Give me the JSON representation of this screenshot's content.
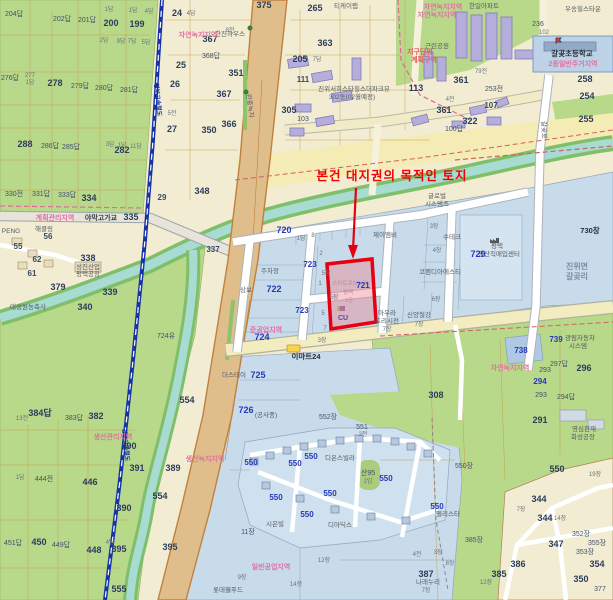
{
  "annotation": {
    "text": "본건 대지권의 목적인 토지",
    "color": "#f50000",
    "outline_color": "#e60012"
  },
  "subject_parcel": {
    "number": "721",
    "building": "스마트큐브누리",
    "city": "평택",
    "unit": "2공",
    "store": "CU"
  },
  "colors": {
    "field_green": "#b8d88a",
    "urban_blue": "#c7dbeb",
    "water": "#a8dbd2",
    "road_tan": "#dfbe8c",
    "railway_blue": "#1733a8",
    "zone_pink": "#e46fa5",
    "parcel_number_blue": "#2639b8",
    "annotation_red": "#f50000"
  },
  "labels": {
    "p204": "204답",
    "p202": "202답",
    "p201": "201답",
    "p200": "200",
    "p199": "199",
    "p1a": "1답",
    "p1b": "1답",
    "p4a": "4답",
    "p2a": "2답",
    "p9a": "9답",
    "p7a": "7답",
    "p5a": "5답",
    "p276": "276답",
    "p277": "277",
    "p277b": "1답",
    "p278": "278",
    "p279": "279답",
    "p280": "280답",
    "p281": "281답",
    "p288": "288",
    "p286": "286답",
    "p285": "285답",
    "p3a": "3답",
    "p1c": "1답",
    "p11a": "11답",
    "p24": "24",
    "p4b": "4답",
    "p25": "25",
    "p26": "26",
    "p27": "27",
    "p5b": "5전",
    "p350": "350",
    "p282": "282",
    "p29": "29",
    "p348": "348",
    "p330": "330전",
    "p331": "331답",
    "p333": "333답",
    "p334": "334",
    "p335": "335",
    "bridge": "야막고가교",
    "z_gyehoek": "계획관리지역",
    "n_haek": "해클링",
    "p56": "56",
    "p55": "55",
    "p62": "62",
    "p61": "61",
    "p338": "338",
    "n_sungjin1": "성진산업",
    "n_sungjin2": "평택공장",
    "p379": "379",
    "p339": "339",
    "p340": "340",
    "n_daesung": "대성원농축사",
    "n_peng": "PENG",
    "rail1": "경부고속철도",
    "rail2": "경부고속철도",
    "n_hanjin": "한진하우스",
    "n_buffer": "완충녹지",
    "p367": "367",
    "p367b": "367",
    "p368": "368답",
    "p8a": "8전",
    "p351": "351",
    "p366": "366",
    "p375": "375",
    "p265": "265",
    "n_tk": "티케이랩",
    "p363": "363",
    "p205": "205",
    "p7b": "7답",
    "p111": "111",
    "n_jinwi1": "진위서희스타힐스더파크뷰",
    "n_jinwi2": "302동(02월예정)",
    "p305": "305",
    "p103": "103",
    "z_nokji0": "자연녹지지역",
    "z_nokji1": "자연녹지지역",
    "z_nokji2": "자연녹지지역",
    "n_park": "근린공원",
    "n_hanil": "한일아파트",
    "n_woosong": "우송힐스타운",
    "p236": "236",
    "p102": "102",
    "n_school": "갈곶초등학교",
    "z_jugeo": "2종일반주거지역",
    "p258": "258",
    "p254": "254",
    "p255": "255",
    "z_jigu1": "지구단위",
    "z_jigu2": "계획구역",
    "p361a": "361",
    "p361b": "361",
    "p322": "322",
    "p113": "113",
    "p107": "107",
    "p100": "100답",
    "p253": "253전",
    "p79": "79전",
    "p4c": "4전",
    "n_road_gal": "갈곶로",
    "p720": "720",
    "p720a": "1답",
    "p720b": "8",
    "p723a": "723",
    "p723b": "723",
    "p337": "337",
    "p722": "722",
    "n_sangbo": "상보",
    "n_parking": "주차장",
    "n_jmb": "제이엠비",
    "n_sutech": "수테크",
    "p3c": "3장",
    "n_global1": "글로벌",
    "n_global2": "시스템즈",
    "n_kopen": "코펜디아에스티",
    "p4d": "4장",
    "p5c": "5장",
    "p6a": "6장",
    "p6b": "6장",
    "n_aura1": "아우라",
    "n_aura2": "프리시전",
    "p7c": "7장",
    "n_shinyang": "신양철강",
    "p7d2": "7장",
    "p3d": "3장",
    "n_ptk1": "평택",
    "n_ptk2": "공산직매입센터",
    "p729": "729",
    "p730": "730창",
    "n_gal1": "진위면",
    "n_gal2": "갈곶리",
    "p738": "738",
    "p739": "739",
    "n_gwang1": "광림자동차",
    "n_gwang2": "시스템",
    "z_nokji3": "자연녹지지역",
    "p296": "296",
    "p297": "297답",
    "p293a": "293",
    "p294a": "294",
    "p293b": "293",
    "p291": "291",
    "p294b": "294답",
    "p308": "308",
    "p550ja": "550장",
    "p550a": "550",
    "p19a": "19장",
    "p344a": "344",
    "p344b": "344",
    "p7e": "7장",
    "p347": "347",
    "p352": "352장",
    "p353": "353장",
    "p355": "355장",
    "p354": "354",
    "p350b": "350",
    "p377": "377",
    "p14a": "14장",
    "n_young1": "영심판재",
    "n_young2": "화성공장",
    "p385j": "385장",
    "p385": "385",
    "p386": "386",
    "p387": "387",
    "n_narae": "나래누리",
    "p7f": "7장",
    "p12a": "12장",
    "p4e": "4전",
    "p3e": "3장",
    "p8b": "8창",
    "p552": "552장",
    "p554a": "554",
    "p554b": "554",
    "p724u": "724유",
    "p384": "384답",
    "p13a": "13전",
    "p383": "383답",
    "p382": "382",
    "p444": "444전",
    "p1d": "1답",
    "p446": "446",
    "p450": "450",
    "p451": "451답",
    "p449": "449답",
    "p448": "448",
    "p390a": "390",
    "p390b": "390",
    "p391": "391",
    "p389": "389",
    "p395a": "395",
    "p395b": "395",
    "p4f": "4답",
    "p555": "555",
    "z_saengsan": "생산관리지역",
    "z_saengnok": "생산녹지지역",
    "z_ilban": "일반공업지역",
    "z_jungong": "준공업지역",
    "p724": "724",
    "p725": "725",
    "n_stay": "더스테이",
    "p726": "726",
    "n_const": "(공사중)",
    "p11b": "11장",
    "p9b": "9장",
    "p14b": "14장",
    "p12b": "12장",
    "n_lotte": "롯데웰푸드",
    "p550v1": "550",
    "p550v2": "550",
    "p550v3": "550",
    "p550v4": "550",
    "p550v5": "550",
    "p550v6": "550",
    "p550v7": "550",
    "p550v8": "550",
    "n_dion": "디온스빌라",
    "n_sieun": "시은빌",
    "n_dia": "디아딕스",
    "n_pelis": "펠리스타",
    "p551": "551",
    "p2b2": "2전",
    "san95": "산95",
    "p2im": "2임",
    "n_mart": "이마트24",
    "n_smart": "스마트큐브누리",
    "p721": "721",
    "n_ptaek2": "평택",
    "n_2g": "2공",
    "n_cu": "CU",
    "t1": "2",
    "t2": "1",
    "t3": "5",
    "t4": "7"
  }
}
